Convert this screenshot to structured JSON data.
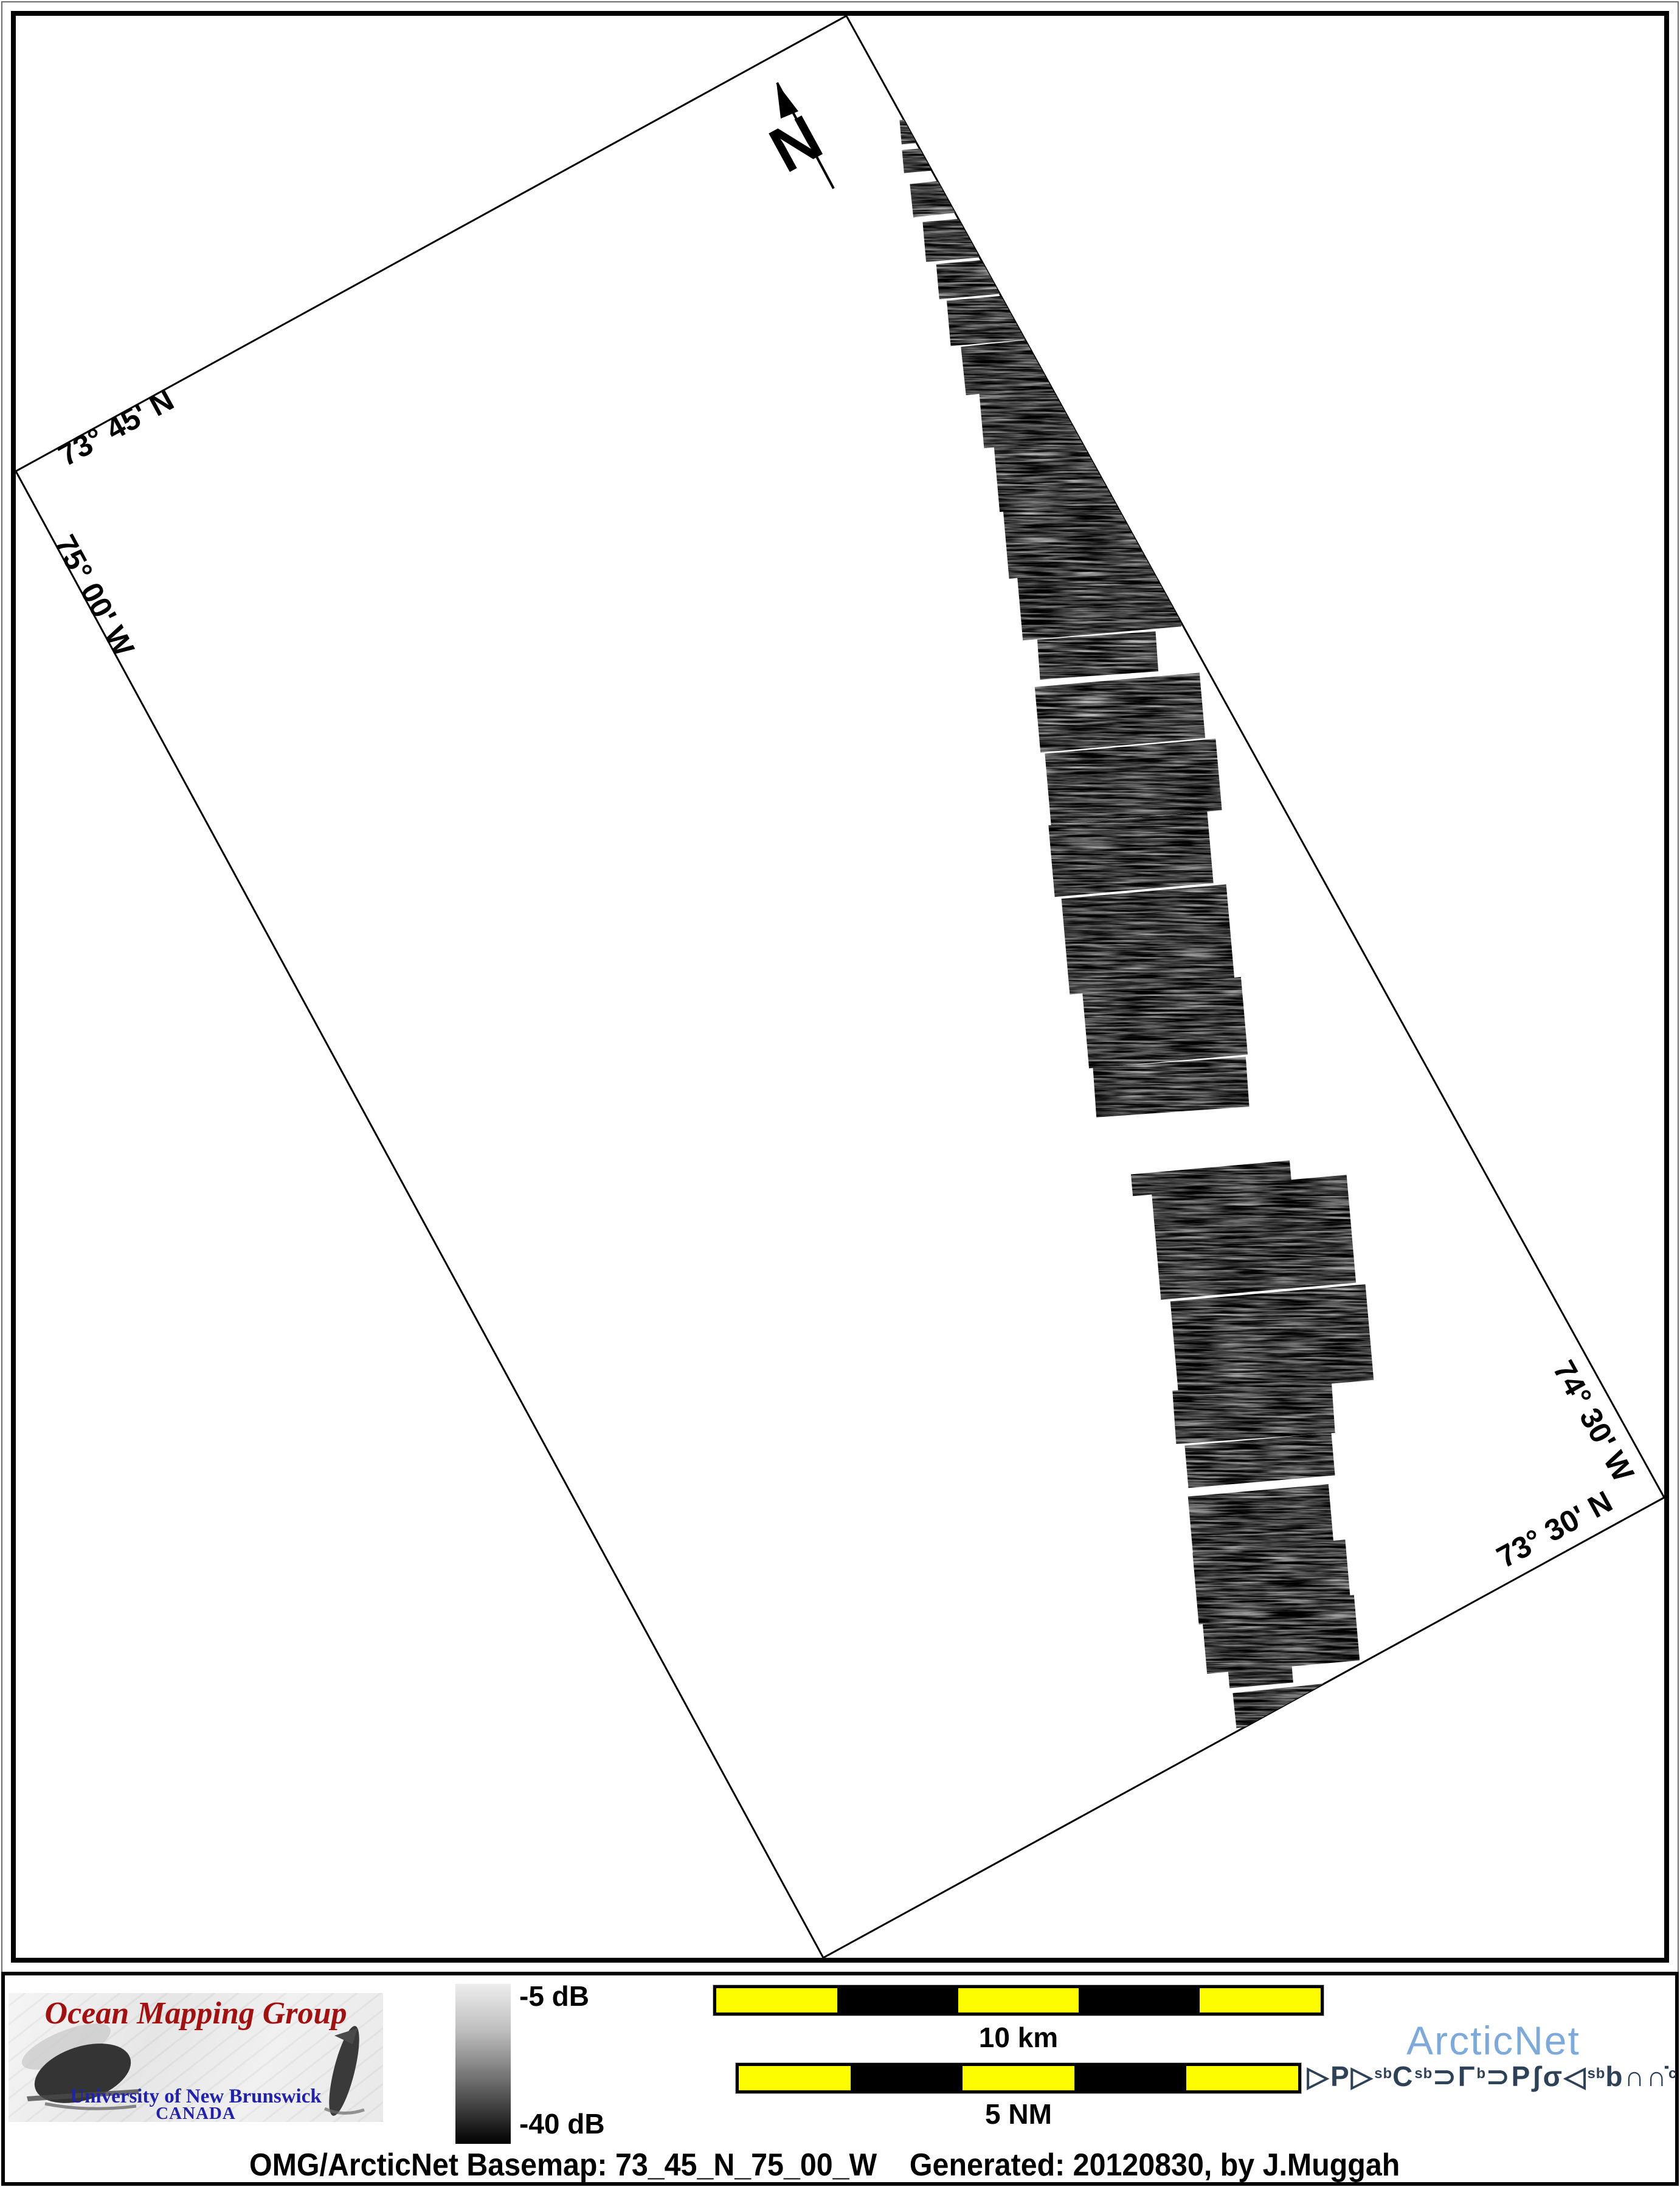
{
  "map": {
    "frame_labels": {
      "top_latitude": "73° 45' N",
      "left_longitude": "75° 00' W",
      "right_longitude": "74° 30' W",
      "bottom_latitude": "73° 30' N"
    },
    "north_arrow_label": "N"
  },
  "legend": {
    "omg_logo": {
      "title": "Ocean Mapping Group",
      "title_color": "#a01212",
      "subtitle1": "University of New Brunswick",
      "subtitle2": "CANADA",
      "subtitle_color": "#2222a6"
    },
    "colorbar": {
      "top_label": "-5 dB",
      "bottom_label": "-40 dB",
      "top_value_db": -5,
      "bottom_value_db": -40
    },
    "scalebars": [
      {
        "label": "10 km",
        "segments": 5,
        "segment_colors": [
          "#fdfd00",
          "#000000"
        ]
      },
      {
        "label": "5 NM",
        "segments": 5,
        "segment_colors": [
          "#fdfd00",
          "#000000"
        ]
      }
    ],
    "arcticnet": {
      "name": "ArcticNet",
      "name_color": "#7fa9d9",
      "syllabics_unicode": "ᐅᑭᐅᖅᑕᖅᑐᒥᒃ ᑐᑭᓯᓂᐊᖃᑎᒌᑦ",
      "syllabics_color": "#2e4156",
      "syllabics_segments": [
        {
          "t": "▷"
        },
        {
          "t": "P"
        },
        {
          "t": "▷"
        },
        {
          "t": "sb",
          "sup": true
        },
        {
          "t": "C"
        },
        {
          "t": "sb",
          "sup": true
        },
        {
          "t": "⊃"
        },
        {
          "t": "Γ"
        },
        {
          "t": "b",
          "sup": true
        },
        {
          "t": "  "
        },
        {
          "t": "⊃"
        },
        {
          "t": "P"
        },
        {
          "t": "ʃ"
        },
        {
          "t": "σ"
        },
        {
          "t": "◁"
        },
        {
          "t": "sb",
          "sup": true
        },
        {
          "t": "b"
        },
        {
          "t": "∩"
        },
        {
          "t": "∩̇"
        },
        {
          "t": "c",
          "sup": true
        }
      ]
    },
    "caption": "OMG/ArcticNet Basemap: 73_45_N_75_00_W    Generated: 20120830, by J.Muggah"
  }
}
